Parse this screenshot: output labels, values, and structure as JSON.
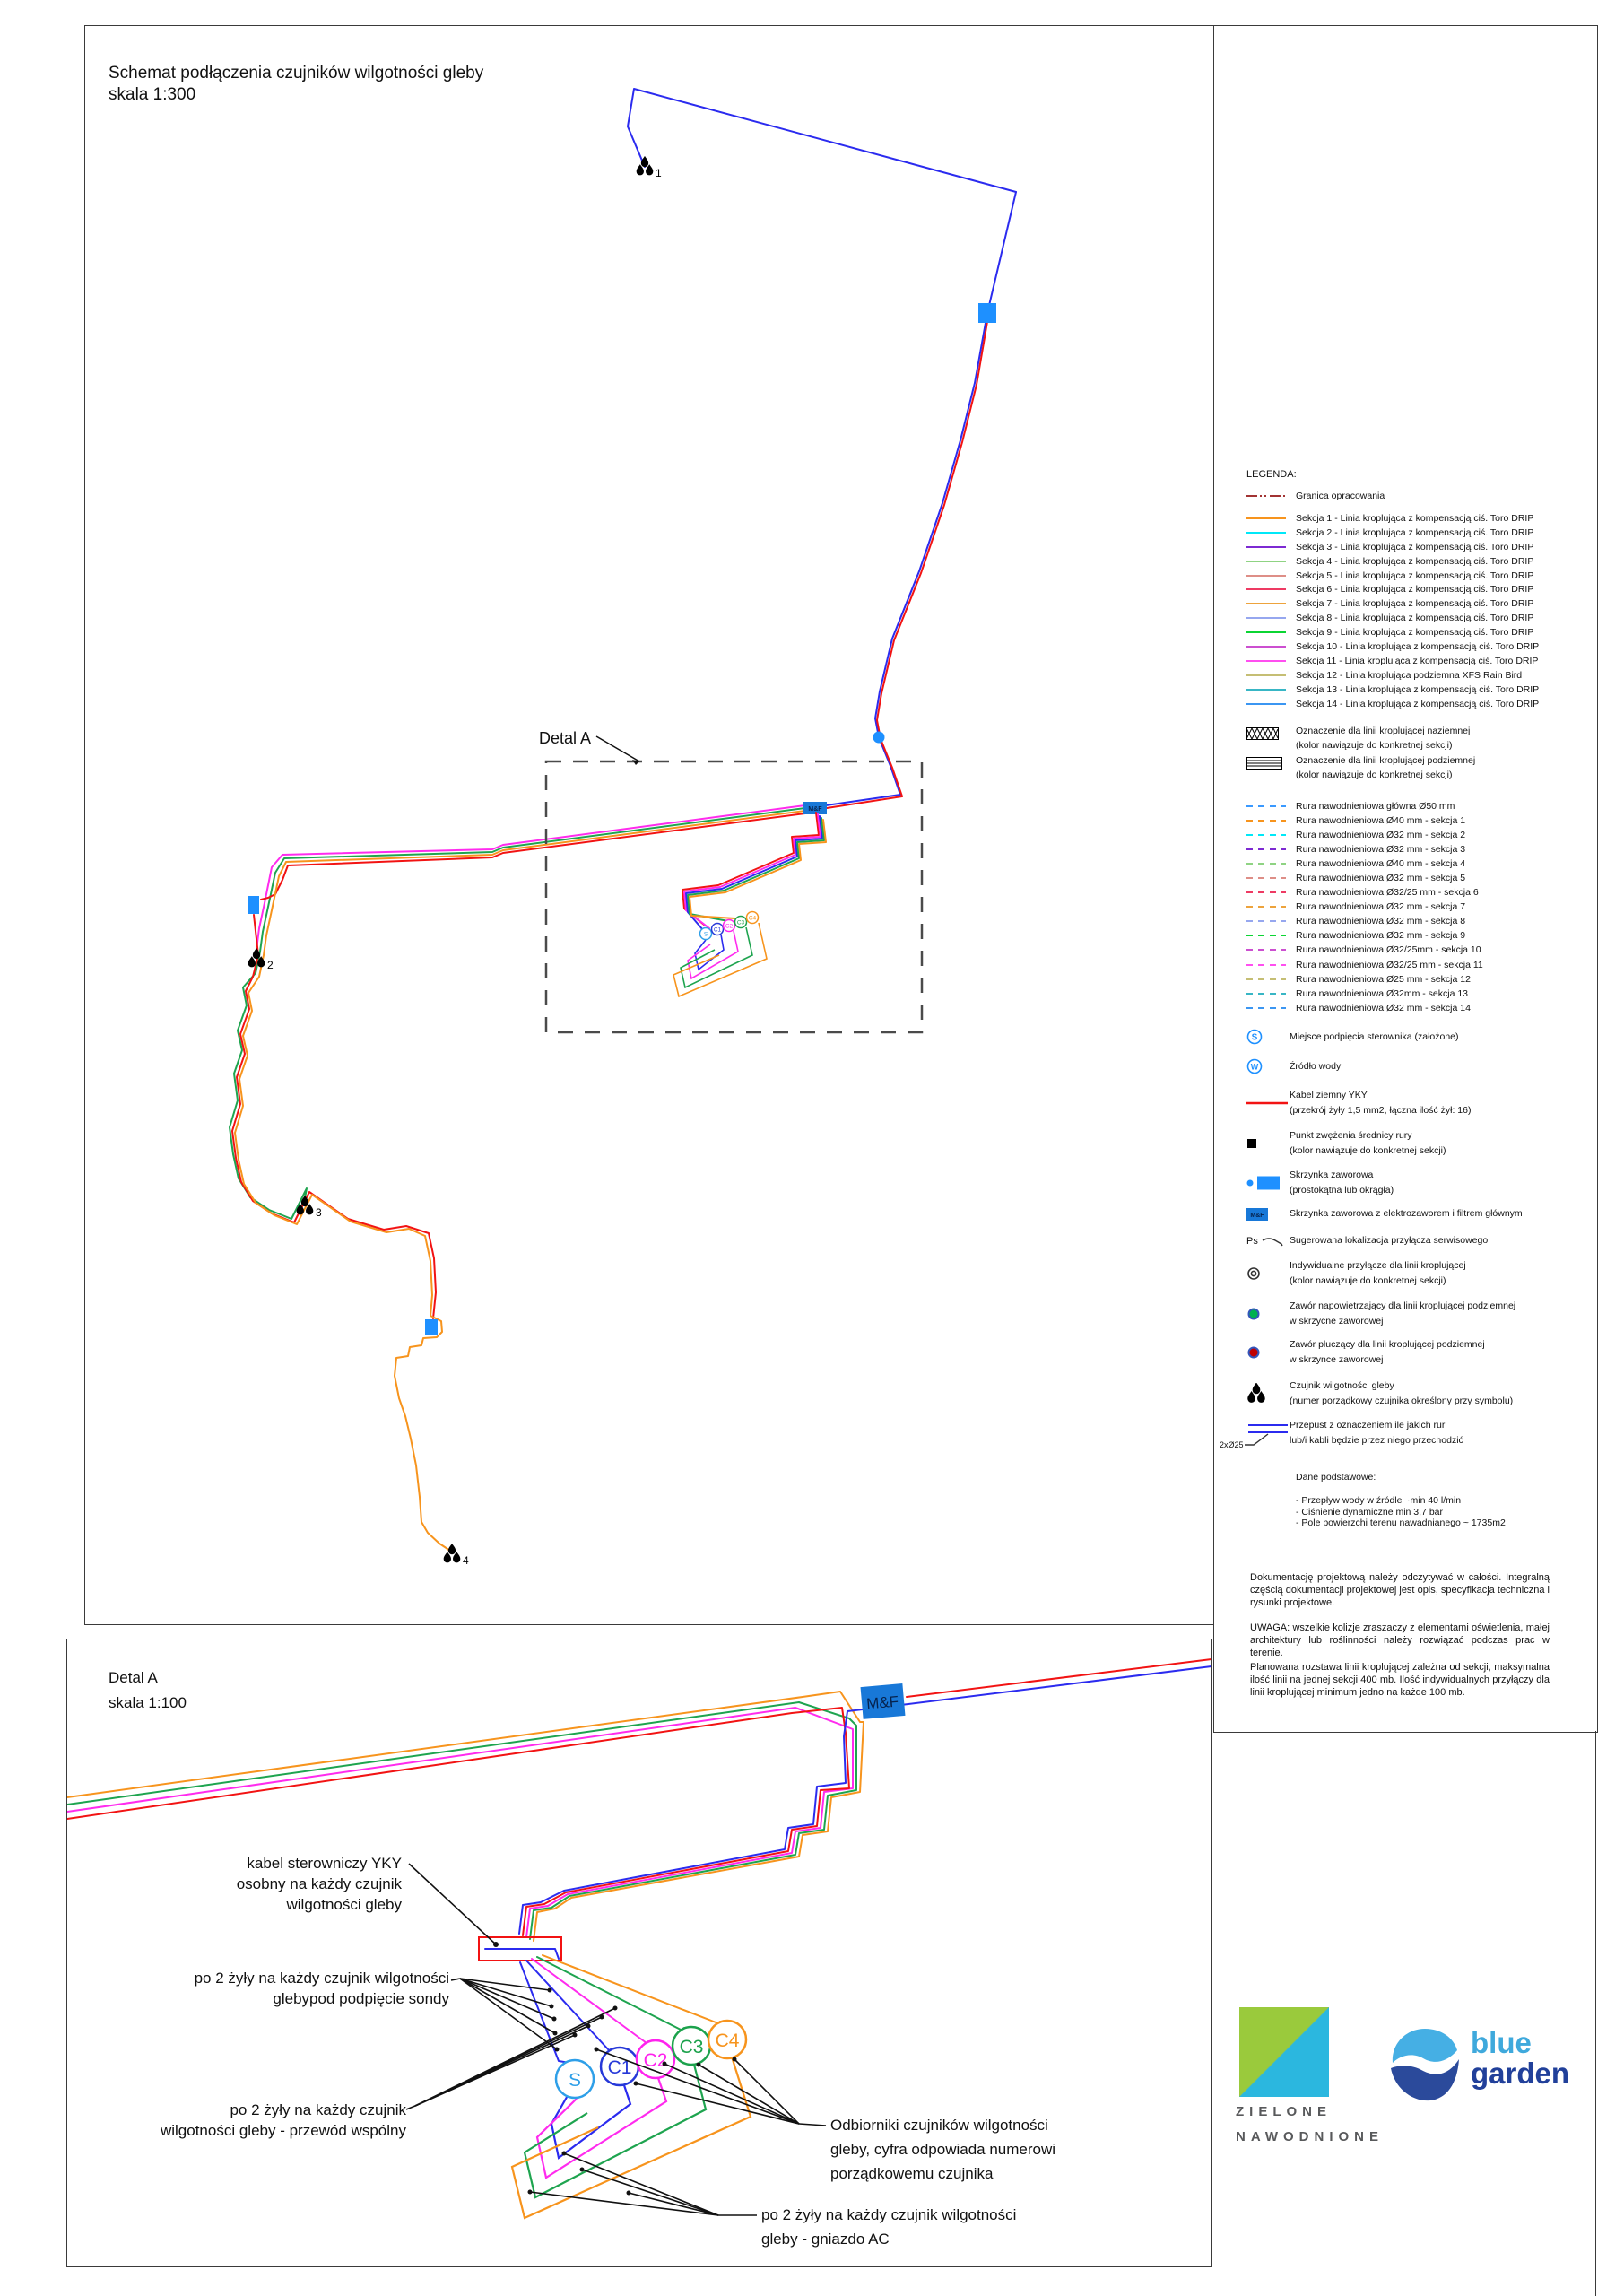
{
  "palette": {
    "drawing_blue": "#2b2bef",
    "drawing_red": "#f21313",
    "drawing_orange": "#f7941d",
    "drawing_green": "#1ea44f",
    "drawing_magenta": "#ff2bee",
    "box_blue": "#1e90ff",
    "granica_color": "#a23333",
    "main_pipe_blue": "#3a99ff"
  },
  "mf_label": "M&F",
  "receivers": [
    "S",
    "C1",
    "C2",
    "C3",
    "C4"
  ],
  "receiver_colors": [
    "#2e9fe8",
    "#2638d8",
    "#ff22ee",
    "#1ca24c",
    "#f7941d"
  ],
  "main_view": {
    "title_line1": "Schemat podłączenia czujników wilgotności gleby",
    "title_line2": "skala 1:300",
    "detail_label": "Detal A",
    "sensor_numbers": [
      "1",
      "2",
      "3",
      "4"
    ]
  },
  "legend": {
    "title": "LEGENDA:",
    "granica_label": "Granica opracowania",
    "sekcje": [
      {
        "label": "Sekcja 1 - Linia kroplująca z kompensacją ciś. Toro DRIP",
        "color": "#f7941d"
      },
      {
        "label": "Sekcja 2 - Linia kroplująca z kompensacją ciś. Toro DRIP",
        "color": "#00e8f8"
      },
      {
        "label": "Sekcja 3 - Linia kroplująca z kompensacją ciś. Toro DRIP",
        "color": "#7d2ad2"
      },
      {
        "label": "Sekcja 4 - Linia kroplująca z kompensacją ciś. Toro DRIP",
        "color": "#8fd383"
      },
      {
        "label": "Sekcja 5 - Linia kroplująca z kompensacją ciś. Toro DRIP",
        "color": "#de8e87"
      },
      {
        "label": "Sekcja 6 - Linia kroplująca z kompensacją ciś. Toro DRIP",
        "color": "#ee3a63"
      },
      {
        "label": "Sekcja 7 - Linia kroplująca z kompensacją ciś. Toro DRIP",
        "color": "#eda33c"
      },
      {
        "label": "Sekcja 8 - Linia kroplująca z kompensacją ciś. Toro DRIP",
        "color": "#96a7ef"
      },
      {
        "label": "Sekcja 9 - Linia kroplująca z kompensacją ciś. Toro DRIP",
        "color": "#0bd533"
      },
      {
        "label": "Sekcja 10 - Linia kroplująca z kompensacją ciś. Toro DRIP",
        "color": "#cc4fd0"
      },
      {
        "label": "Sekcja 11 - Linia kroplująca z kompensacją ciś. Toro DRIP",
        "color": "#ff4ff0"
      },
      {
        "label": "Sekcja 12 - Linia kroplująca podziemna XFS Rain Bird",
        "color": "#c5be74"
      },
      {
        "label": "Sekcja 13 - Linia kroplująca z kompensacją ciś. Toro DRIP",
        "color": "#38b6c5"
      },
      {
        "label": "Sekcja 14 - Linia kroplująca z kompensacją ciś. Toro DRIP",
        "color": "#3b96f2"
      }
    ],
    "oznaczenia": [
      {
        "line1": "Oznaczenie dla linii kroplującej naziemnej",
        "line2": "(kolor nawiązuje do konkretnej sekcji)"
      },
      {
        "line1": "Oznaczenie dla linii kroplującej podziemnej",
        "line2": "(kolor nawiązuje do konkretnej sekcji)"
      }
    ],
    "rury": [
      {
        "label": "Rura nawodnieniowa główna Ø50 mm",
        "color": "#3a99ff"
      },
      {
        "label": "Rura nawodnieniowa Ø40 mm - sekcja 1",
        "color": "#f7941d"
      },
      {
        "label": "Rura nawodnieniowa Ø32 mm - sekcja 2",
        "color": "#00e8f8"
      },
      {
        "label": "Rura nawodnieniowa Ø32 mm - sekcja 3",
        "color": "#7d2ad2"
      },
      {
        "label": "Rura nawodnieniowa Ø40 mm - sekcja 4",
        "color": "#8fd383"
      },
      {
        "label": "Rura nawodnieniowa Ø32 mm - sekcja 5",
        "color": "#de8e87"
      },
      {
        "label": "Rura nawodnieniowa Ø32/25 mm - sekcja 6",
        "color": "#ee3a63"
      },
      {
        "label": "Rura nawodnieniowa Ø32 mm - sekcja 7",
        "color": "#eda33c"
      },
      {
        "label": "Rura nawodnieniowa Ø32 mm - sekcja 8",
        "color": "#96a7ef"
      },
      {
        "label": "Rura nawodnieniowa Ø32 mm - sekcja 9",
        "color": "#0bd533"
      },
      {
        "label": "Rura nawodnieniowa Ø32/25mm - sekcja 10",
        "color": "#cc4fd0"
      },
      {
        "label": "Rura nawodnieniowa Ø32/25 mm - sekcja 11",
        "color": "#ff4ff0"
      },
      {
        "label": "Rura nawodnieniowa Ø25 mm - sekcja 12",
        "color": "#c5be74"
      },
      {
        "label": "Rura nawodnieniowa Ø32mm - sekcja 13",
        "color": "#38b6c5"
      },
      {
        "label": "Rura nawodnieniowa Ø32 mm - sekcja 14",
        "color": "#3b96f2"
      }
    ],
    "symbols": {
      "sterownik": {
        "icon_letter": "S",
        "l1": "Miejsce podpięcia sterownika (założone)"
      },
      "woda": {
        "icon_letter": "W",
        "l1": "Źródło wody"
      },
      "kabel": {
        "l1": "Kabel ziemny YKY",
        "l2": "(przekrój żyły 1,5 mm2, łączna ilość żył: 16)"
      },
      "punkt": {
        "l1": "Punkt zwężenia średnicy rury",
        "l2": "(kolor nawiązuje do konkretnej sekcji)"
      },
      "skrzynka": {
        "l1": "Skrzynka zaworowa",
        "l2": "(prostokątna lub okrągła)"
      },
      "skrzynka_mf": {
        "l1": "Skrzynka zaworowa z elektrozaworem i filtrem głównym"
      },
      "ps": {
        "icon_letter": "Ps",
        "l1": "Sugerowana lokalizacja przyłącza serwisowego"
      },
      "przylacze": {
        "l1": "Indywidualne przyłącze dla linii kroplującej",
        "l2": "(kolor nawiązuje do konkretnej sekcji)"
      },
      "zawor_nap": {
        "l1": "Zawór napowietrzający dla linii kroplującej podziemnej",
        "l2": "w skrzycne zaworowej"
      },
      "zawor_plucz": {
        "l1": "Zawór płuczący dla linii kroplującej podziemnej",
        "l2": "w skrzynce zaworowej"
      },
      "czujnik": {
        "l1": "Czujnik wilgotności gleby",
        "l2": "(numer porządkowy czujnika określony przy symbolu)"
      },
      "przepust": {
        "tag": "2xØ25",
        "l1": "Przepust z oznaczeniem ile jakich rur",
        "l2": "lub/i kabli będzie przez niego przechodzić"
      }
    },
    "dane": {
      "title": "Dane podstawowe:",
      "items": [
        {
          "text": "- Przepływ wody w źródle ~min 40 l/min"
        },
        {
          "text": "- Ciśnienie dynamiczne min 3,7 bar"
        },
        {
          "text": "- Pole powierzchi terenu nawadnianego ~ 1735m2"
        }
      ]
    },
    "paragraphs": {
      "p1": "Dokumentację projektową należy odczytywać w całości. Integralną częścią dokumentacji projektowej jest opis, specyfikacja techniczna i rysunki projektowe.",
      "p2": "UWAGA: wszelkie kolizje zraszaczy z elementami oświetlenia, małej architektury lub roślinności należy rozwiązać podczas prac w terenie.",
      "p3": "Planowana rozstawa linii kroplującej zależna od sekcji, maksymalna ilość linii na jednej sekcji 400 mb. Ilość indywidualnych przyłączy dla linii kroplującej minimum jedno na każde 100 mb."
    }
  },
  "detail_view": {
    "title_line1": "Detal  A",
    "title_line2": "skala 1:100",
    "labels": {
      "l1": [
        "kabel sterowniczy YKY",
        "osobny na każdy czujnik",
        "wilgotności gleby"
      ],
      "l2": [
        "po 2 żyły na każdy czujnik wilgotności",
        "glebypod podpięcie sondy"
      ],
      "l3": [
        "po 2 żyły na każdy czujnik",
        "wilgotności gleby - przewód wspólny"
      ],
      "l4": [
        "Odbiorniki czujników wilgotności",
        "gleby, cyfra odpowiada numerowi",
        "porządkowemu czujnika"
      ],
      "l5": [
        "po 2 żyły na każdy czujnik wilgotności",
        "gleby - gniazdo AC"
      ]
    }
  },
  "logos": {
    "zielone_line1": "ZIELONE",
    "zielone_line2": "NAWODNIONE",
    "blue": "blue",
    "garden": "garden"
  }
}
